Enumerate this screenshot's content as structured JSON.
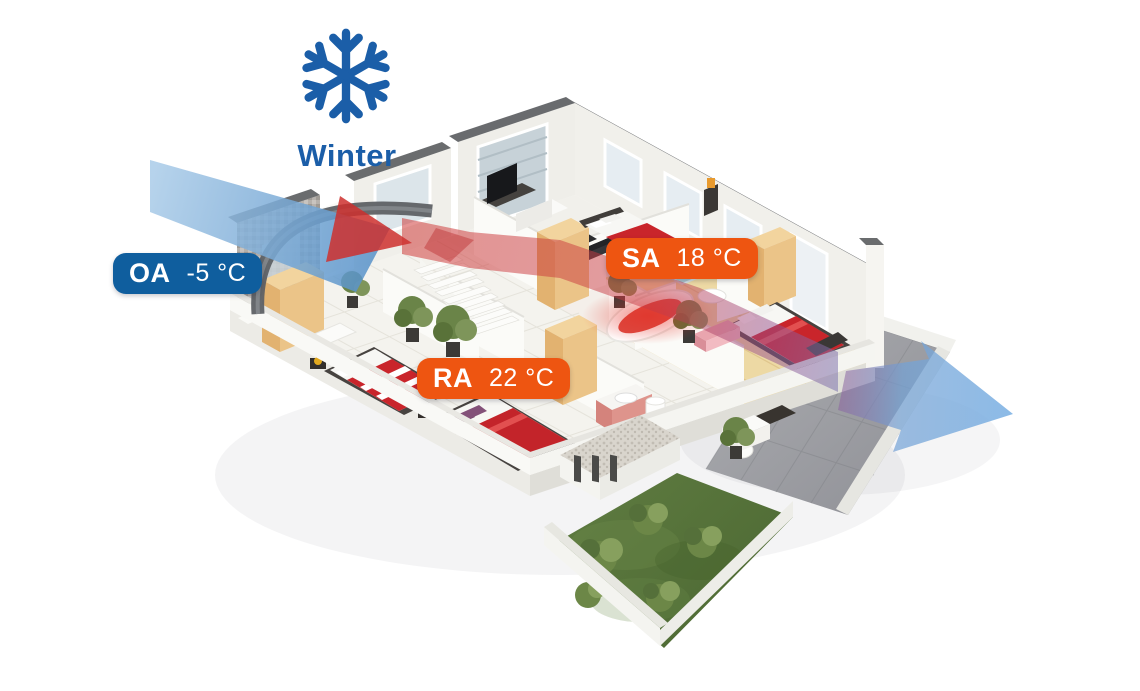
{
  "header": {
    "season": "Winter",
    "icon": "snowflake-icon",
    "color": "#1B5EA8"
  },
  "labels": {
    "oa": {
      "code": "OA",
      "temperature": "-5 °C",
      "background": "#0F5E9E"
    },
    "sa": {
      "code": "SA",
      "temperature": "18 °C",
      "background": "#EE5511"
    },
    "ra": {
      "code": "RA",
      "temperature": "22 °C",
      "background": "#EE5511"
    }
  },
  "airflows": {
    "inlet": {
      "name": "outdoor-air-flow",
      "color": "#5E9BD0"
    },
    "supply": {
      "name": "supply-air-flow",
      "color": "#D4484A"
    },
    "exhaust": {
      "name": "exhaust-air-flow",
      "color": "#7FB0DE"
    }
  }
}
